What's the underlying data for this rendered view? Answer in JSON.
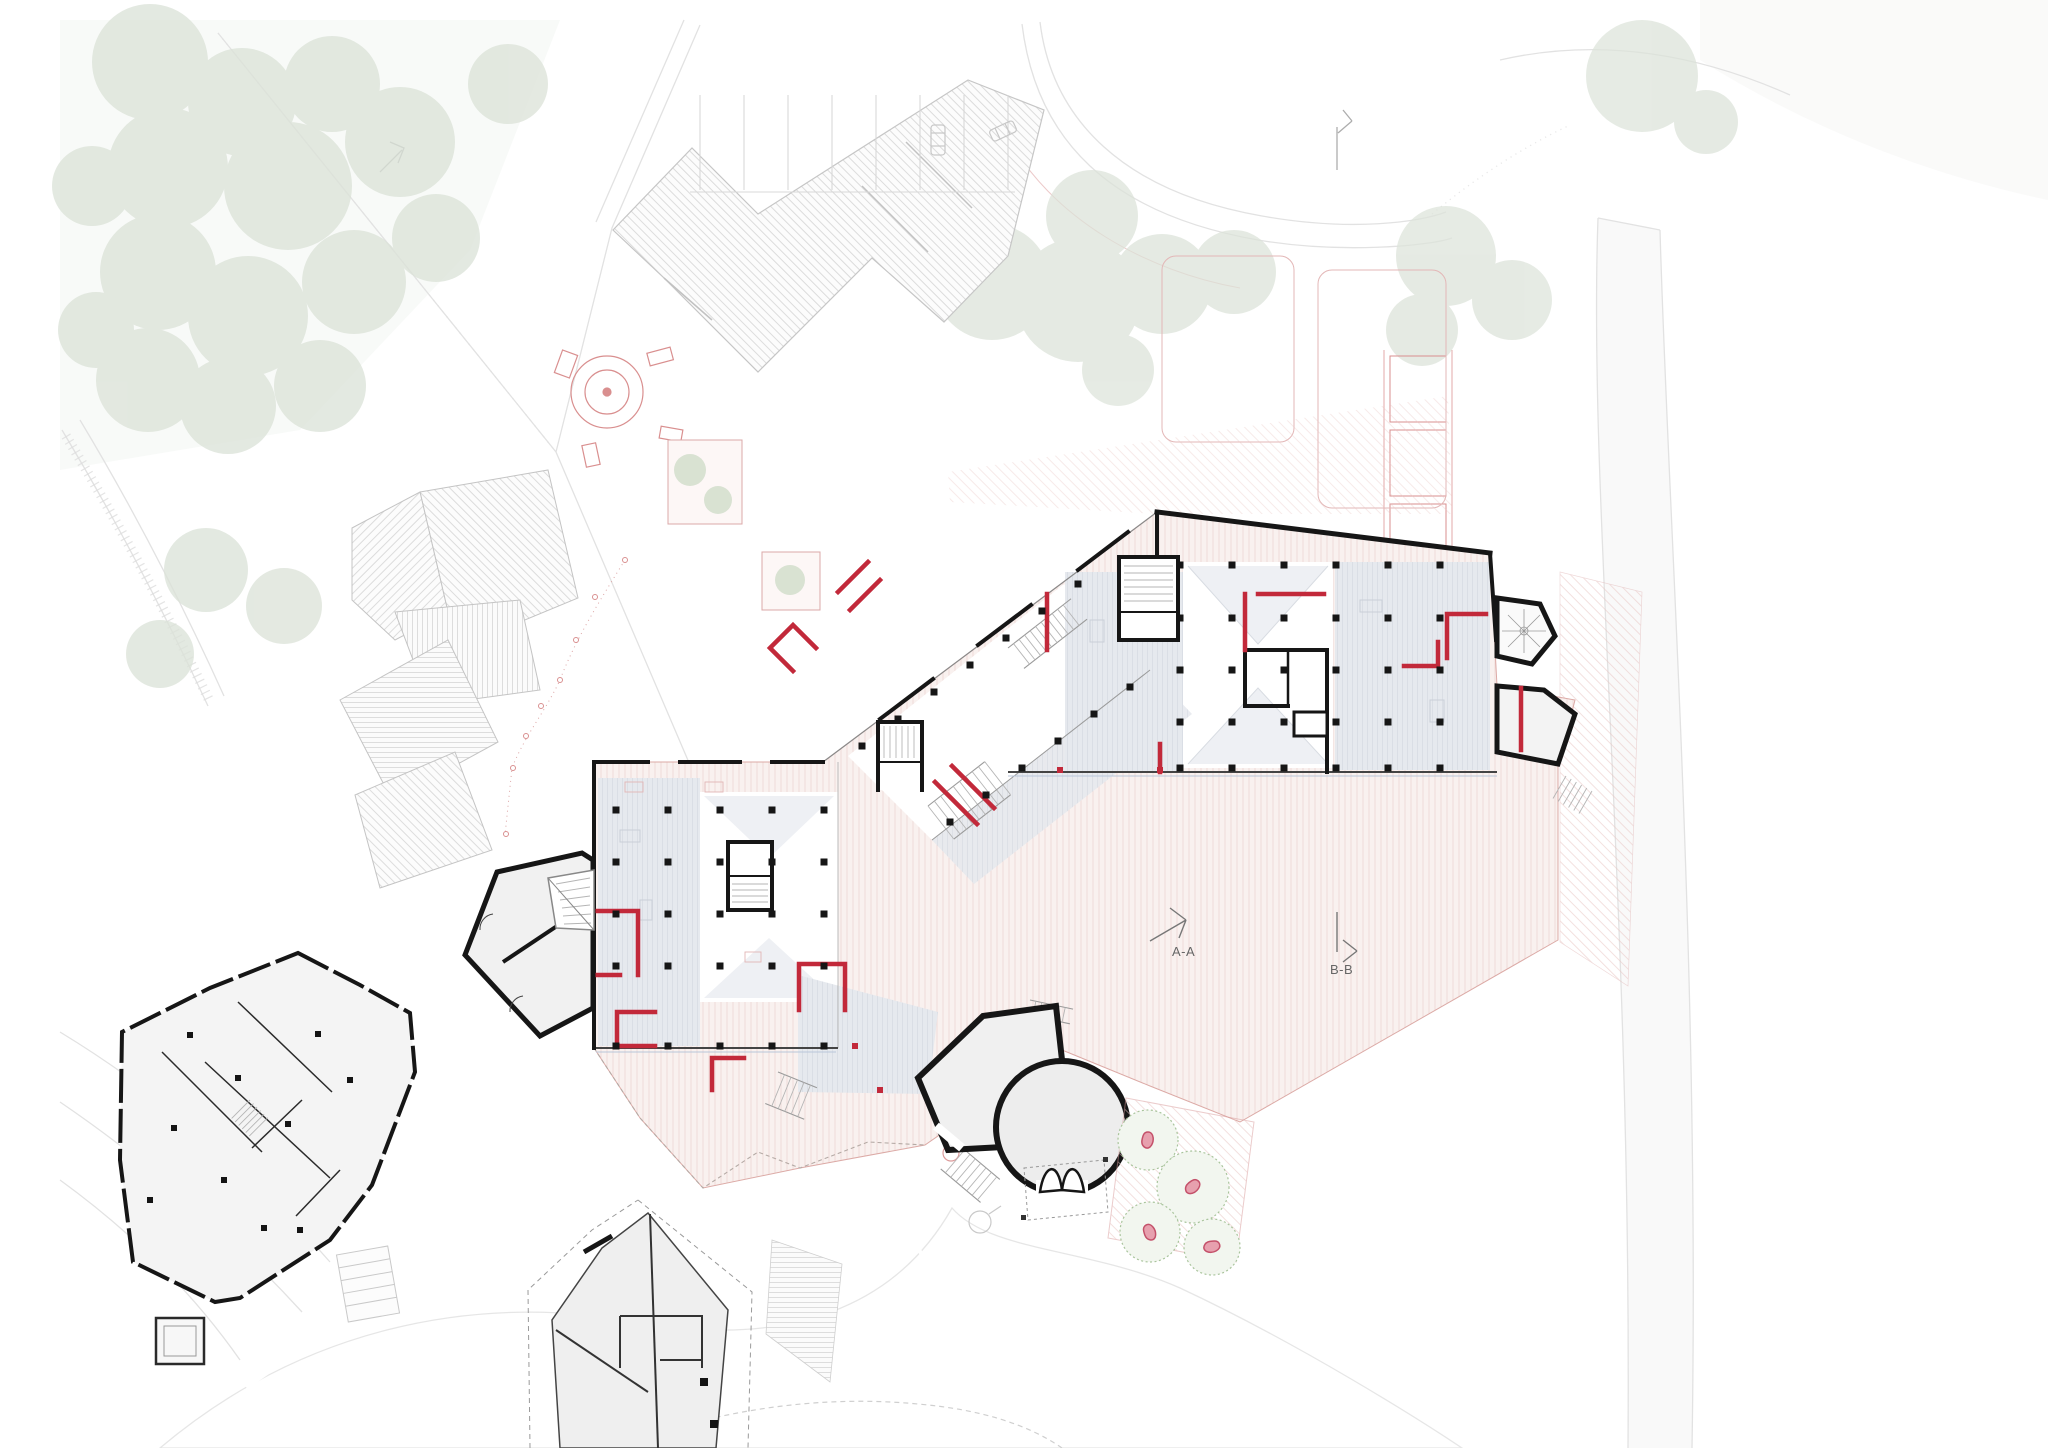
{
  "labels": {
    "section_a": "A-A",
    "section_b": "B-B"
  },
  "palette": {
    "background": "#ffffff",
    "wall_black": "#161616",
    "accent_red": "#c2293a",
    "floor_pink_hatch": "#f0dad7",
    "room_bluegray": "#e6e9ee",
    "context_gray": "#c9c9c9",
    "tree_green": "#dce3d9",
    "tree_outline_green": "#a9c49c",
    "fruit_red": "#c4516a",
    "marker_gray": "#777777",
    "plaza_gray": "#f1f1f1"
  }
}
